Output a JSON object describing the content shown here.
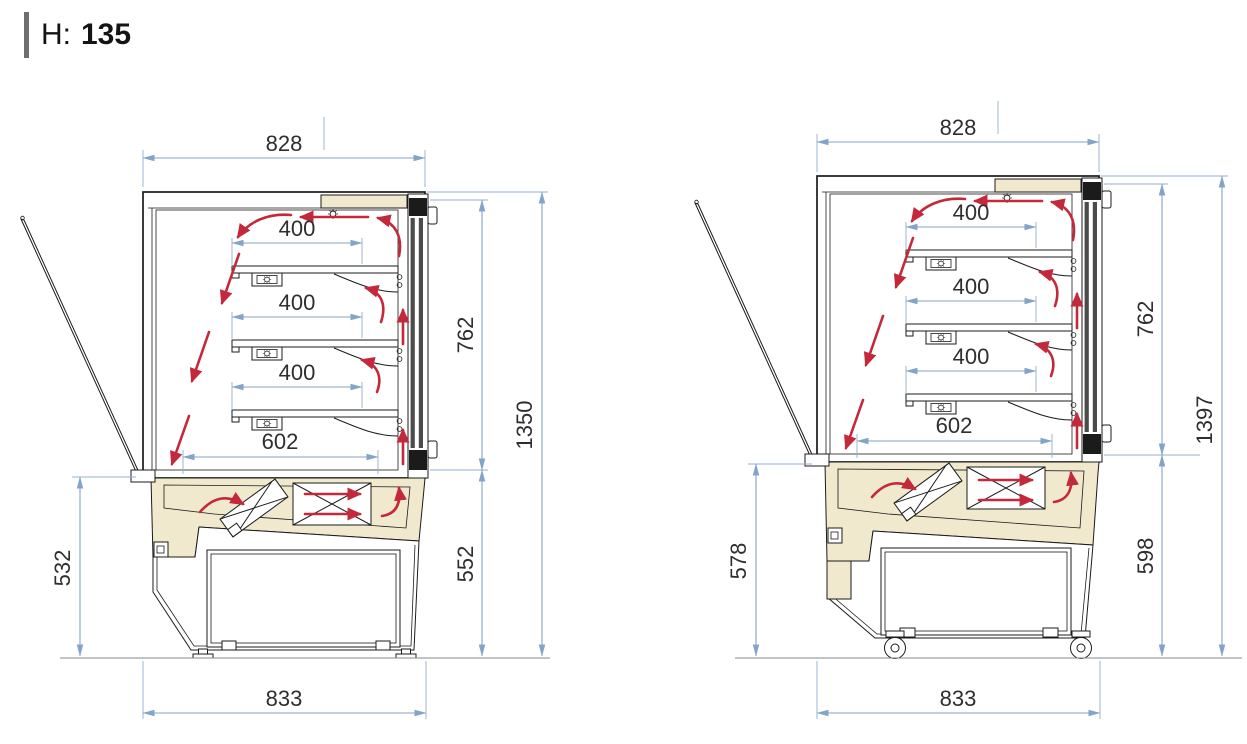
{
  "header": {
    "label": "H:",
    "value": "135"
  },
  "drawing": {
    "type": "technical-dimension-diagram",
    "description": "Side section views of a refrigerated display case with air circulation arrows",
    "colors": {
      "dimension_lines": "#84a3c8",
      "dimension_text": "#2e2e2e",
      "airflow_arrows": "#c4293b",
      "panel_beige": "#f0e9cd",
      "drawing_lines": "#1b1b1b"
    },
    "icons": {
      "lamp": "lamp-icon",
      "fan_unit": "fan-crossed-box-icon",
      "evaporator": "angled-coil-icon",
      "caster": "caster-wheel-icon",
      "foot": "leveling-foot-icon",
      "airflow": "airflow-arrow-icon"
    },
    "views": [
      {
        "id": "left",
        "variant": "on leveling feet",
        "dimensions": {
          "top_width": "828",
          "shelf_depth_1": "400",
          "shelf_depth_2": "400",
          "shelf_depth_3": "400",
          "inner_bottom_depth": "602",
          "display_glass_height": "762",
          "overall_height": "1350",
          "lower_front_height": "532",
          "lower_rear_height": "552",
          "base_depth": "833"
        }
      },
      {
        "id": "right",
        "variant": "on casters",
        "dimensions": {
          "top_width": "828",
          "shelf_depth_1": "400",
          "shelf_depth_2": "400",
          "shelf_depth_3": "400",
          "inner_bottom_depth": "602",
          "display_glass_height": "762",
          "overall_height": "1397",
          "lower_front_height": "578",
          "lower_rear_height": "598",
          "base_depth": "833"
        }
      }
    ]
  }
}
